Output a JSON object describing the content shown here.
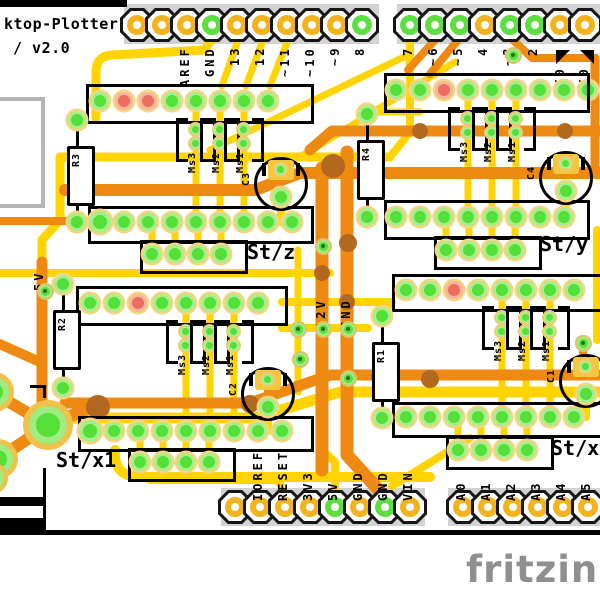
{
  "app": {
    "title_line1": "ktop-Plotter",
    "title_line2": "/ v2.0",
    "watermark": "fritzing"
  },
  "colors": {
    "copper_top": "#ee8a12",
    "copper_bottom": "#ffd400",
    "silkscreen": "#d2d2d2",
    "pad_green": "#55df39",
    "pad_red": "#ed6d5e",
    "pad_gold": "#f2b31d",
    "overlap": "#b2691f",
    "board": "#ffffff"
  },
  "headers": {
    "digital_left": {
      "labels": [
        "",
        "",
        "AREF",
        "GND",
        "13",
        "12",
        "~11",
        "~10",
        "~9",
        "8"
      ],
      "green_pins": [
        3,
        9
      ]
    },
    "digital_right": {
      "labels": [
        "7",
        "~6",
        "~5",
        "4",
        "~3",
        "2",
        "",
        ""
      ],
      "green_pins": [
        0,
        1,
        2,
        4,
        5
      ],
      "tx_label": "TX0",
      "rx_label": "RX0"
    },
    "power": {
      "labels": [
        "",
        "IOREF",
        "RESET",
        "3V3",
        "5V",
        "GND",
        "GND",
        "VIN"
      ],
      "green_pins": [
        4,
        6
      ]
    },
    "analog": {
      "labels": [
        "A0",
        "A1",
        "A2",
        "A3",
        "A4",
        "A5"
      ],
      "green_pins": []
    }
  },
  "rails": {
    "v5": "5V",
    "v12": "12V",
    "gnd": "GND"
  },
  "stepper_blocks": [
    {
      "id": "z",
      "st_label": "St/z",
      "cap_label": "C3",
      "res_label": "R3",
      "ms_labels": [
        "Ms3",
        "Ms2",
        "Ms1"
      ],
      "top_pads": [
        "green",
        "red",
        "red",
        "green",
        "green",
        "green",
        "green",
        "green"
      ],
      "bottom_pads": [
        "big",
        "green",
        "green",
        "green",
        "green",
        "green",
        "green",
        "green",
        "green"
      ]
    },
    {
      "id": "y",
      "st_label": "St/y",
      "cap_label": "C4",
      "res_label": "R4",
      "ms_labels": [
        "Ms3",
        "Ms2",
        "Ms1"
      ],
      "top_pads": [
        "green",
        "green",
        "red",
        "green",
        "green",
        "green",
        "green",
        "green"
      ],
      "bottom_pads": [
        "green",
        "green",
        "green",
        "green",
        "green",
        "green",
        "green",
        "green"
      ]
    },
    {
      "id": "x1",
      "st_label": "St/x1",
      "cap_label": "C2",
      "res_label": "R2",
      "ms_labels": [
        "Ms3",
        "Ms2",
        "Ms1"
      ],
      "top_pads": [
        "green",
        "green",
        "red",
        "green",
        "green",
        "green",
        "green",
        "green"
      ],
      "bottom_pads": [
        "big",
        "green",
        "green",
        "green",
        "green",
        "green",
        "green",
        "green",
        "green"
      ]
    },
    {
      "id": "x2",
      "st_label": "St/x",
      "cap_label": "C1",
      "res_label": "R1",
      "ms_labels": [
        "Ms3",
        "Ms2",
        "Ms1"
      ],
      "top_pads": [
        "green",
        "green",
        "red",
        "green",
        "green",
        "green",
        "green",
        "green"
      ],
      "bottom_pads": [
        "green",
        "green",
        "green",
        "green",
        "green",
        "green",
        "green",
        "green"
      ]
    }
  ]
}
